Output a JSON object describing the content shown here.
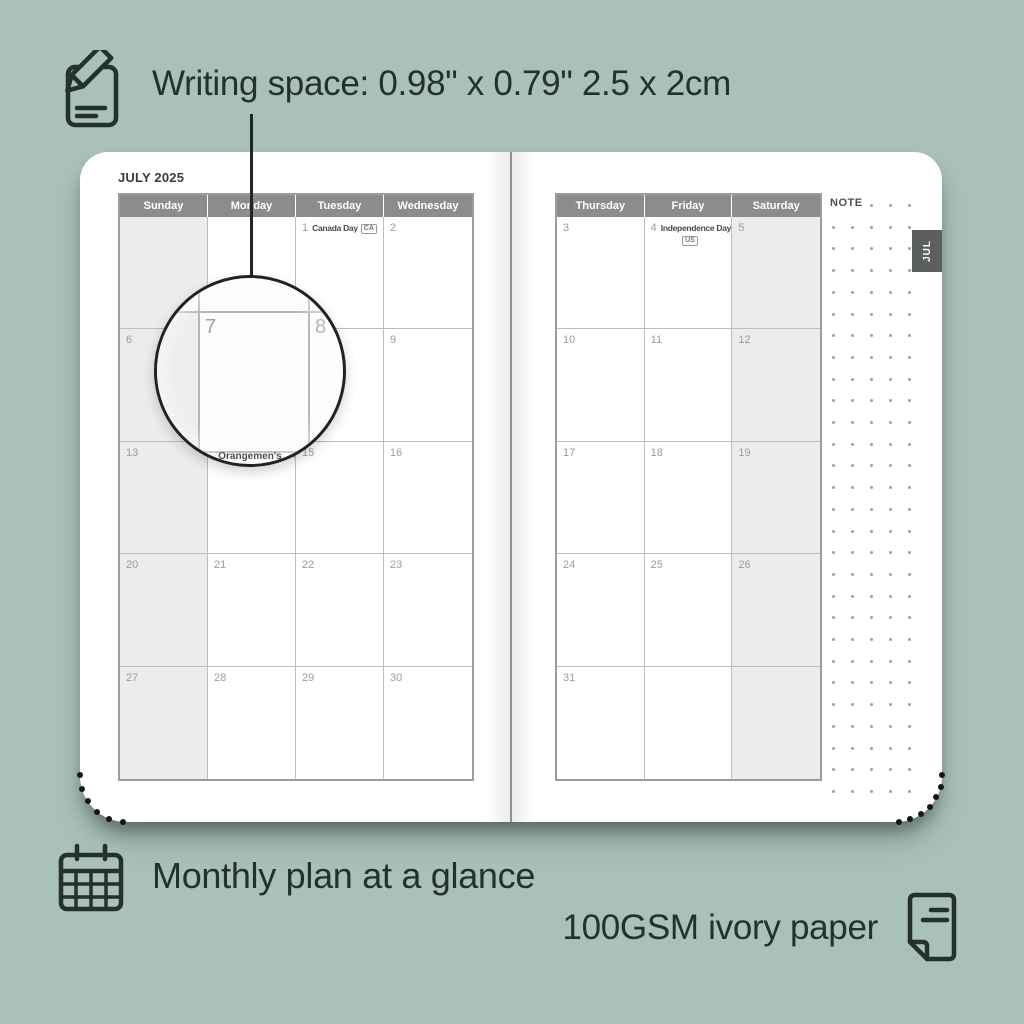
{
  "colors": {
    "background": "#a9c1b9",
    "text": "#24312d",
    "header_bar": "#8c8c8c",
    "weekend_shade": "#ececec",
    "grid_line": "#bdbdbd",
    "tab_bg": "#5c605d",
    "date_number": "#9b9b9b"
  },
  "icons": {
    "writing": "note-pencil-icon",
    "monthly": "calendar-grid-icon",
    "paper": "paper-sheet-icon"
  },
  "callouts": {
    "writing_space": "Writing space: 0.98\" x 0.79\" 2.5 x 2cm",
    "monthly_plan": "Monthly plan at a glance",
    "paper": "100GSM ivory paper"
  },
  "planner": {
    "month_title": "JULY 2025",
    "note_label": "NOTE",
    "tab_label": "JUL",
    "magnifier": {
      "left_day": "7",
      "right_day": "8",
      "edge_text": "Orangemen's"
    },
    "left_page": {
      "day_headers": [
        "Sunday",
        "Monday",
        "Tuesday",
        "Wednesday"
      ],
      "weeks": [
        [
          {
            "day": "",
            "shaded": true
          },
          {
            "day": ""
          },
          {
            "day": "1",
            "holiday": "Canada Day",
            "badge": "CA"
          },
          {
            "day": "2"
          }
        ],
        [
          {
            "day": "6",
            "shaded": true
          },
          {
            "day": "7"
          },
          {
            "day": "8"
          },
          {
            "day": "9"
          }
        ],
        [
          {
            "day": "13",
            "shaded": true
          },
          {
            "day": "14",
            "holiday": "Orangemen's Day"
          },
          {
            "day": "15"
          },
          {
            "day": "16"
          }
        ],
        [
          {
            "day": "20",
            "shaded": true
          },
          {
            "day": "21"
          },
          {
            "day": "22"
          },
          {
            "day": "23"
          }
        ],
        [
          {
            "day": "27",
            "shaded": true
          },
          {
            "day": "28"
          },
          {
            "day": "29"
          },
          {
            "day": "30"
          }
        ]
      ]
    },
    "right_page": {
      "day_headers": [
        "Thursday",
        "Friday",
        "Saturday"
      ],
      "weeks": [
        [
          {
            "day": "3"
          },
          {
            "day": "4",
            "holiday": "Independence Day",
            "badge": "US",
            "badge_below": true
          },
          {
            "day": "5",
            "shaded": true
          }
        ],
        [
          {
            "day": "10"
          },
          {
            "day": "11"
          },
          {
            "day": "12",
            "shaded": true
          }
        ],
        [
          {
            "day": "17"
          },
          {
            "day": "18"
          },
          {
            "day": "19",
            "shaded": true
          }
        ],
        [
          {
            "day": "24"
          },
          {
            "day": "25"
          },
          {
            "day": "26",
            "shaded": true
          }
        ],
        [
          {
            "day": "31"
          },
          {
            "day": ""
          },
          {
            "day": "",
            "shaded": true
          }
        ]
      ]
    }
  }
}
